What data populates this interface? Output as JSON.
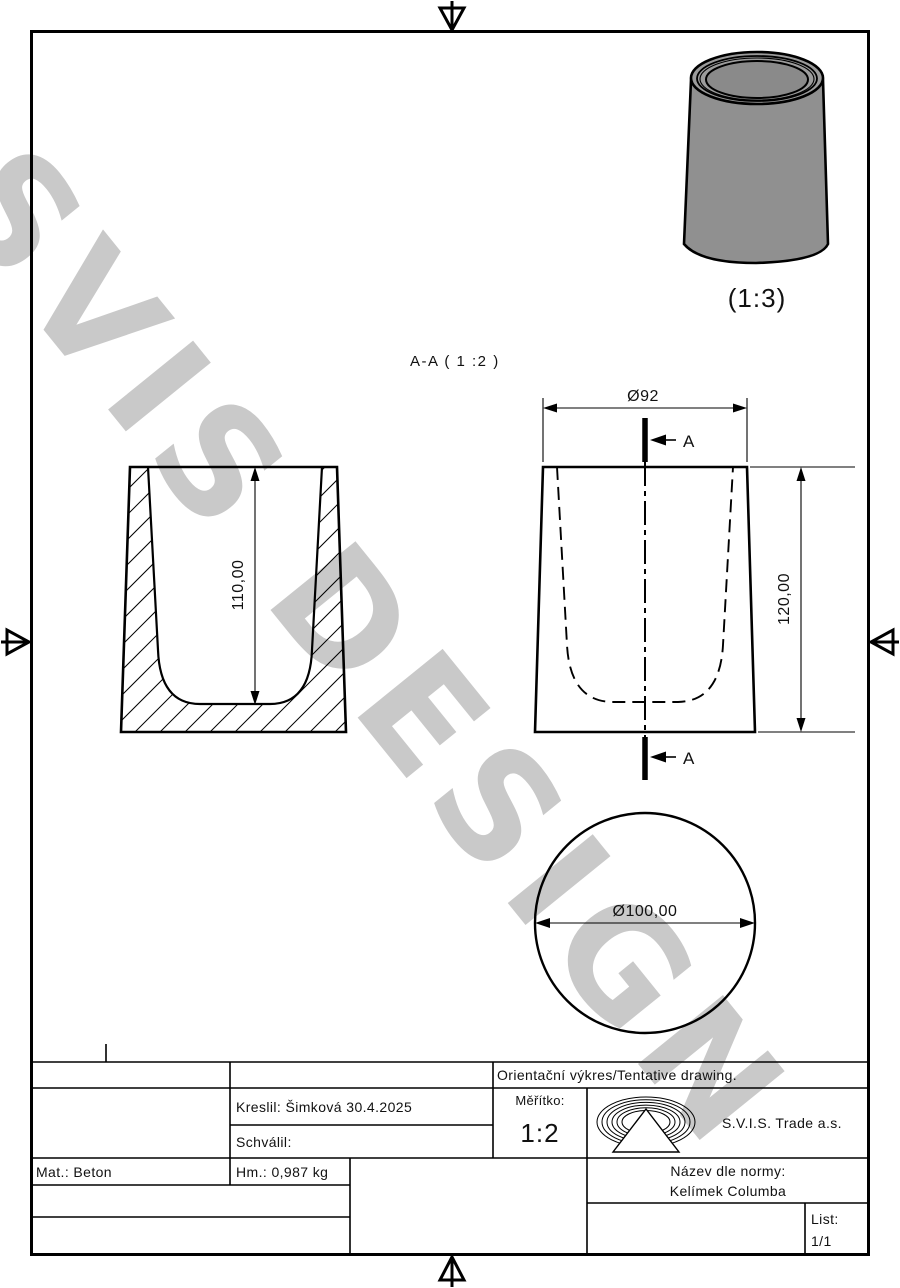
{
  "watermark": {
    "text": "SVIS DESIGN"
  },
  "drawing": {
    "iso_scale_label": "(1:3)",
    "section_title": "A-A ( 1 :2 )",
    "section_marker_top": "A",
    "section_marker_bottom": "A",
    "dim_inner_depth": "110,00",
    "dim_top_diameter": "Ø92",
    "dim_total_height": "120,00",
    "dim_bottom_diameter": "Ø100,00"
  },
  "title_block": {
    "orientacni": "Orientační výkres/Tentative drawing.",
    "kreslil": "Kreslil: Šimková 30.4.2025",
    "schvalil": "Schválil:",
    "meritko_label": "Měřítko:",
    "meritko_value": "1:2",
    "company": "S.V.I.S. Trade a.s.",
    "material": "Mat.: Beton",
    "weight": "Hm.: 0,987 kg",
    "norm_name_label": "Název dle normy:",
    "norm_name_value": "Kelímek Columba",
    "list_label": "List:",
    "list_value": "1/1"
  }
}
